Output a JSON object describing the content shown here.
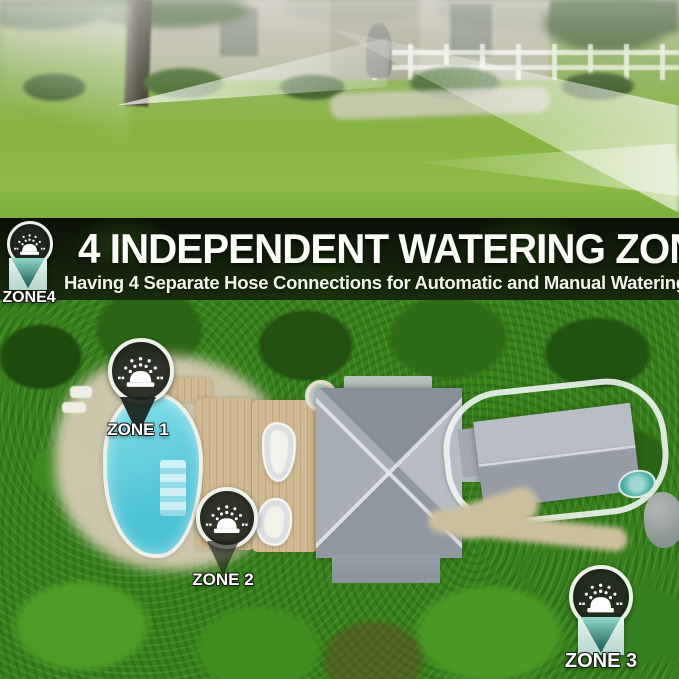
{
  "banner": {
    "title": "4 INDEPENDENT WATERING ZONE",
    "subtitle": "Having 4 Separate Hose Connections for Automatic and Manual Watering"
  },
  "zones": {
    "zone1": {
      "label": "ZONE 1",
      "icon": "sprinkler-icon"
    },
    "zone2": {
      "label": "ZONE 2",
      "icon": "sprinkler-icon"
    },
    "zone3": {
      "label": "ZONE 3",
      "icon": "sprinkler-icon"
    },
    "zone4": {
      "label": "ZONE4",
      "icon": "sprinkler-icon"
    }
  },
  "colors": {
    "pool_cyan": "#5fcbdc",
    "marker_teal": "#2e8f84",
    "band_dark": "#101d08",
    "lawn_green": "#86b43f",
    "foliage_green": "#37811c",
    "roof_gray": "#a3a9b2",
    "sand_beige": "#d6cbb4",
    "deck_tan": "#cdb68e",
    "text_white": "#ffffff"
  }
}
